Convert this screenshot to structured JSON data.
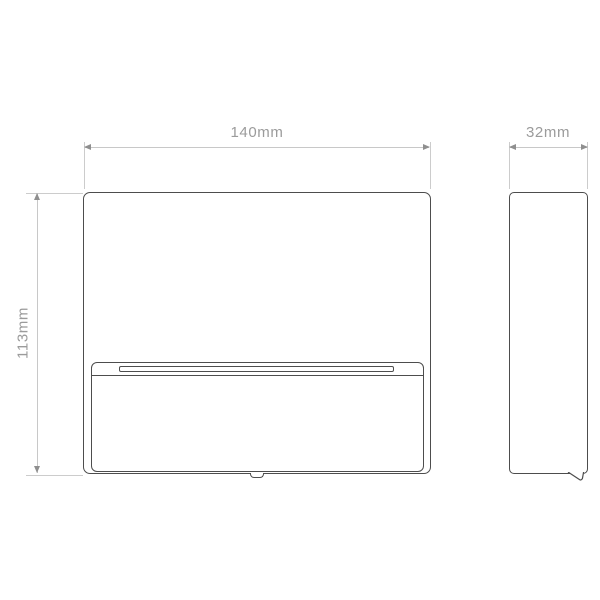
{
  "drawing": {
    "type": "technical-dimension-drawing",
    "subject": "rectangular wall light, front and side elevation",
    "background_color": "#ffffff",
    "outline_color": "#4d4d4d",
    "dimension_line_color": "#c8c8c8",
    "arrow_color": "#8f8f8f",
    "label_color": "#9b9b9b",
    "views": {
      "front": {
        "name": "front elevation",
        "features": [
          "rounded outer body",
          "lower front panel",
          "horizontal light slot",
          "small bottom tab"
        ]
      },
      "side": {
        "name": "side elevation",
        "features": [
          "rounded slim profile",
          "bottom front flap"
        ]
      }
    },
    "dimensions": {
      "width": {
        "label": "140mm",
        "value_mm": 140
      },
      "depth": {
        "label": "32mm",
        "value_mm": 32
      },
      "height": {
        "label": "113mm",
        "value_mm": 113
      }
    }
  }
}
